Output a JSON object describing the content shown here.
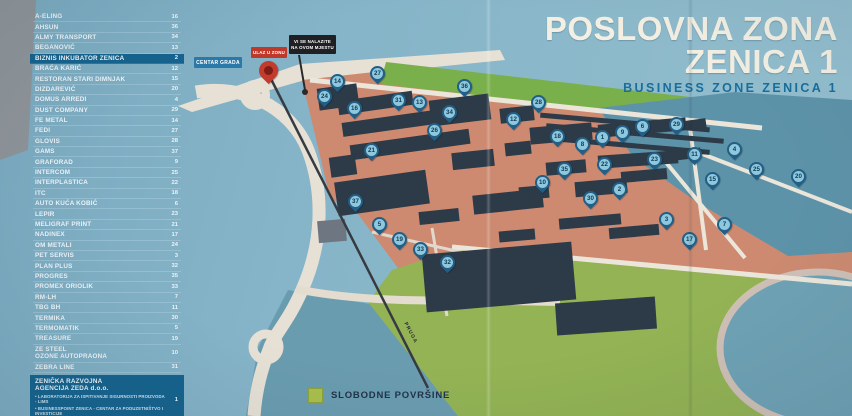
{
  "billboard": {
    "title_line1": "POSLOVNA ZONA",
    "title_line2": "ZENICA 1",
    "subtitle": "BUSINESS ZONE ZENICA 1"
  },
  "legend": {
    "items": [
      {
        "name": "A-ELING",
        "num": "16"
      },
      {
        "name": "AHSUN",
        "num": "36"
      },
      {
        "name": "ALMY TRANSPORT",
        "num": "34"
      },
      {
        "name": "BEGANOVIĆ",
        "num": "13"
      },
      {
        "name": "BIZNIS INKUBATOR ZENICA",
        "num": "2",
        "hl": true
      },
      {
        "name": "BRAĆA KARIĆ",
        "num": "12"
      },
      {
        "name": "RESTORAN STARI DIMNJAK",
        "num": "15"
      },
      {
        "name": "DIZDAREVIĆ",
        "num": "20"
      },
      {
        "name": "DOMUS ARREDI",
        "num": "4"
      },
      {
        "name": "DUST COMPANY",
        "num": "29"
      },
      {
        "name": "FE METAL",
        "num": "14"
      },
      {
        "name": "FEDI",
        "num": "27"
      },
      {
        "name": "GLOVIS",
        "num": "28"
      },
      {
        "name": "GAMS",
        "num": "37"
      },
      {
        "name": "GRAFORAD",
        "num": "9"
      },
      {
        "name": "INTERCOM",
        "num": "25"
      },
      {
        "name": "INTERPLASTICA",
        "num": "22"
      },
      {
        "name": "ITC",
        "num": "18"
      },
      {
        "name": "AUTO KUĆA KOBIĆ",
        "num": "6"
      },
      {
        "name": "LEPIR",
        "num": "23"
      },
      {
        "name": "MELIGRAF PRINT",
        "num": "21"
      },
      {
        "name": "NADINEX",
        "num": "17"
      },
      {
        "name": "OM METALI",
        "num": "24"
      },
      {
        "name": "PET SERVIS",
        "num": "3"
      },
      {
        "name": "PLAN PLUS",
        "num": "32"
      },
      {
        "name": "PROGRES",
        "num": "35"
      },
      {
        "name": "PROMEX ORIOLIK",
        "num": "33"
      },
      {
        "name": "RM-LH",
        "num": "7"
      },
      {
        "name": "TBG BH",
        "num": "11"
      },
      {
        "name": "TERMIKA",
        "num": "30"
      },
      {
        "name": "TERMOMATIK",
        "num": "5"
      },
      {
        "name": "TREASURE",
        "num": "19"
      },
      {
        "name": "ZE STEEL",
        "name2": "OZONE AUTOPRAONA",
        "num": "10"
      },
      {
        "name": "ZEBRA LINE",
        "num": "31"
      }
    ],
    "zeda": {
      "title_line1": "ZENIČKA RAZVOJNA",
      "title_line2": "AGENCIJA ZEDA d.o.o.",
      "num": "1",
      "bullets": [
        "LABORATORIJA ZA ISPITIVANJE SIGURNOSTI PROIZVODA - LIMS",
        "BUSINESSPOINT ZENICA - CENTAR ZA PODUZETNIŠTVO I INVESTICIJE",
        "INOVATIVNO KREATIVNI CENTAR - IKC"
      ]
    },
    "zaluzine": {
      "name": "ŽALUZINE STYLE",
      "num": "8",
      "hl": true
    }
  },
  "map": {
    "labels": {
      "centar_grada": "CENTAR GRADA",
      "ulaz_u_zonu": "ULAZ U ZONU",
      "you_are_here_line1": "VI SE NALAZITE",
      "you_are_here_line2": "NA OVOM MJESTU",
      "railway": "PRUGA",
      "free_area": "SLOBODNE POVRŠINE"
    },
    "pins": [
      {
        "n": "14",
        "x": 337,
        "y": 92
      },
      {
        "n": "24",
        "x": 324,
        "y": 107
      },
      {
        "n": "27",
        "x": 377,
        "y": 84
      },
      {
        "n": "16",
        "x": 354,
        "y": 119
      },
      {
        "n": "31",
        "x": 398,
        "y": 111
      },
      {
        "n": "13",
        "x": 419,
        "y": 113
      },
      {
        "n": "34",
        "x": 449,
        "y": 123
      },
      {
        "n": "26",
        "x": 434,
        "y": 141
      },
      {
        "n": "36",
        "x": 464,
        "y": 97
      },
      {
        "n": "21",
        "x": 371,
        "y": 161
      },
      {
        "n": "12",
        "x": 513,
        "y": 130
      },
      {
        "n": "28",
        "x": 538,
        "y": 113
      },
      {
        "n": "18",
        "x": 557,
        "y": 147
      },
      {
        "n": "8",
        "x": 582,
        "y": 155
      },
      {
        "n": "1",
        "x": 602,
        "y": 148
      },
      {
        "n": "9",
        "x": 622,
        "y": 143
      },
      {
        "n": "6",
        "x": 642,
        "y": 137
      },
      {
        "n": "22",
        "x": 604,
        "y": 175
      },
      {
        "n": "35",
        "x": 564,
        "y": 180
      },
      {
        "n": "10",
        "x": 542,
        "y": 193
      },
      {
        "n": "30",
        "x": 590,
        "y": 209
      },
      {
        "n": "2",
        "x": 619,
        "y": 200
      },
      {
        "n": "23",
        "x": 654,
        "y": 170
      },
      {
        "n": "29",
        "x": 676,
        "y": 135
      },
      {
        "n": "11",
        "x": 694,
        "y": 165
      },
      {
        "n": "15",
        "x": 712,
        "y": 190
      },
      {
        "n": "4",
        "x": 734,
        "y": 160
      },
      {
        "n": "25",
        "x": 756,
        "y": 180
      },
      {
        "n": "20",
        "x": 798,
        "y": 187
      },
      {
        "n": "7",
        "x": 724,
        "y": 235
      },
      {
        "n": "17",
        "x": 689,
        "y": 250
      },
      {
        "n": "3",
        "x": 666,
        "y": 230
      },
      {
        "n": "37",
        "x": 355,
        "y": 212
      },
      {
        "n": "5",
        "x": 379,
        "y": 235
      },
      {
        "n": "19",
        "x": 399,
        "y": 250
      },
      {
        "n": "33",
        "x": 420,
        "y": 260
      },
      {
        "n": "32",
        "x": 447,
        "y": 273
      }
    ]
  },
  "colors": {
    "highlight_blue": "#15638e",
    "pin_blue": "#235e84",
    "accent_red": "#bf392b",
    "parcel_salmon": "#cd8a71",
    "free_green": "#a9bf4b",
    "river_teal": "#5d93a9"
  }
}
